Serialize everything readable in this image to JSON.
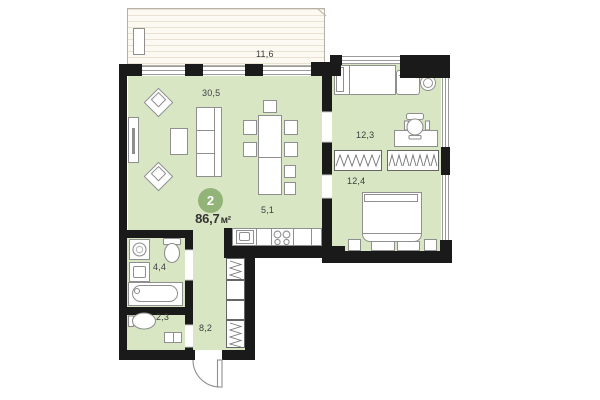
{
  "plan": {
    "badge": {
      "rooms_count": "2",
      "total_area": "86,7",
      "area_unit": "м²"
    },
    "rooms": [
      {
        "name": "terrace",
        "area": "11,6"
      },
      {
        "name": "living-room",
        "area": "30,5"
      },
      {
        "name": "bedroom-upper",
        "area": "12,3"
      },
      {
        "name": "bedroom-lower",
        "area": "12,4"
      },
      {
        "name": "kitchen",
        "area": "5,1"
      },
      {
        "name": "bathroom",
        "area": "4,4"
      },
      {
        "name": "wc",
        "area": "2,3"
      },
      {
        "name": "hallway",
        "area": "8,2"
      }
    ],
    "colors": {
      "room_fill": "#d9e6c4",
      "wall": "#1a1a1a",
      "badge_fill": "#93b478",
      "terrace_fill": "#fbf9f2",
      "terrace_line": "#e9e2d3",
      "furniture_stroke": "#8f8f8f",
      "text": "#3d3d3d"
    }
  }
}
